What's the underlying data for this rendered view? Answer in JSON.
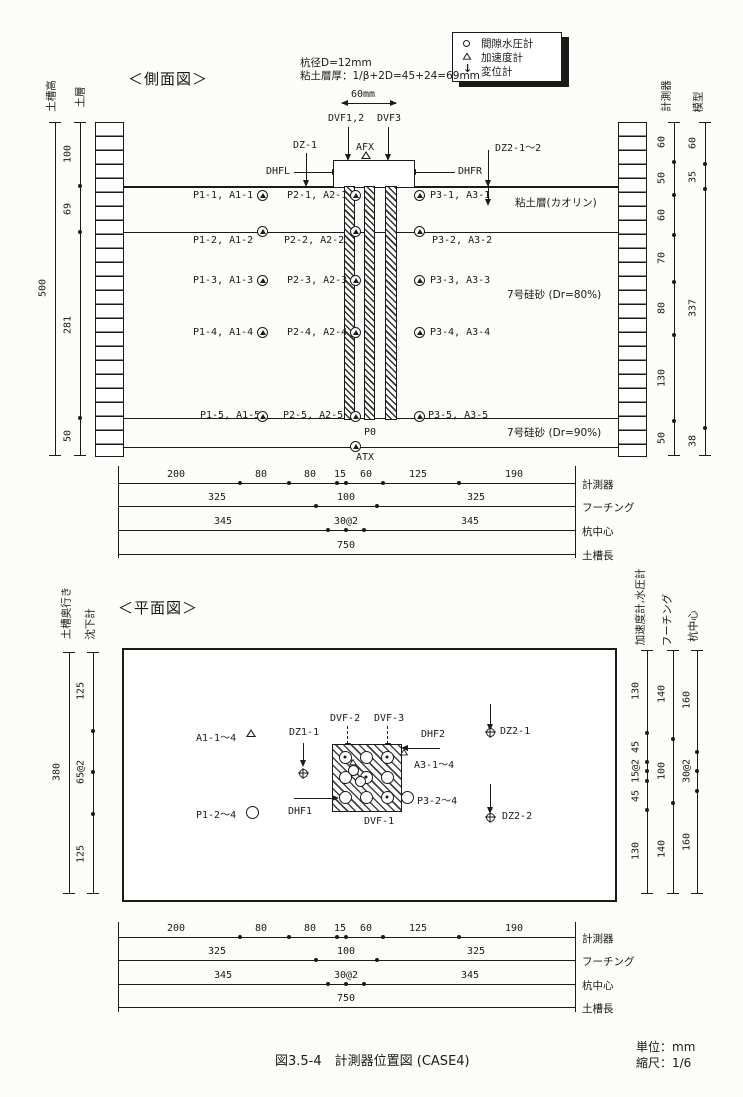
{
  "legend": {
    "items": [
      {
        "icon": "circle",
        "label": "間隙水圧計"
      },
      {
        "icon": "triangle",
        "label": "加速度計"
      },
      {
        "icon": "arrow-down",
        "label": "変位計"
      }
    ]
  },
  "side_view": {
    "title": "＜側面図＞",
    "notes": {
      "line1": "杭径D=12mm",
      "line2": "粘土層厚：1/β+2D=45+24=69mm"
    },
    "width_label": "60mm",
    "labels": {
      "dvf12": "DVF1,2",
      "dvf3": "DVF3",
      "dz1": "DZ-1",
      "afx": "AFX",
      "dhfl": "DHFL",
      "dhfr": "DHFR",
      "dz2": "DZ2-1〜2",
      "p0": "P0",
      "atx": "ATX"
    },
    "soil": {
      "clay": "粘土層(カオリン)",
      "sand80": "7号硅砂 (Dr=80%)",
      "sand90": "7号硅砂 (Dr=90%)"
    },
    "rows": [
      {
        "left": "P1-1, A1-1",
        "center": "P2-1, A2-1",
        "right": "P3-1, A3-1"
      },
      {
        "left": "P1-2, A1-2",
        "center": "P2-2, A2-2",
        "right": "P3-2, A3-2"
      },
      {
        "left": "P1-3, A1-3",
        "center": "P2-3, A2-3",
        "right": "P3-3, A3-3"
      },
      {
        "left": "P1-4, A1-4",
        "center": "P2-4, A2-4",
        "right": "P3-4, A3-4"
      },
      {
        "left": "P1-5, A1-5",
        "center": "P2-5, A2-5",
        "right": "P3-5, A3-5"
      }
    ],
    "left_dims": {
      "header_outer": "土槽高",
      "header_inner": "土層",
      "total": "500",
      "segments": [
        "100",
        "69",
        "281",
        "50"
      ]
    },
    "right_dims": {
      "header_col1": "計測器",
      "header_col2": "模型",
      "col1_segments": [
        "60",
        "50",
        "60",
        "70",
        "80",
        "130",
        "50"
      ],
      "col2_segments": [
        "60",
        "35",
        "337",
        "38"
      ]
    }
  },
  "plan_view": {
    "title": "＜平面図＞",
    "labels": {
      "a1": "A1-1〜4",
      "dz11": "DZ1-1",
      "dvf2": "DVF-2",
      "dvf3": "DVF-3",
      "dhf2": "DHF2",
      "a3": "A3-1〜4",
      "p3": "P3-2〜4",
      "dhf1": "DHF1",
      "dvf1": "DVF-1",
      "p1": "P1-2〜4",
      "dz21": "DZ2-1",
      "dz22": "DZ2-2"
    },
    "left_dims": {
      "header_outer": "土槽奥行き",
      "header_inner": "沈下計",
      "total": "380",
      "segments": [
        "125",
        "65@2",
        "125"
      ]
    },
    "right_dims": {
      "header_col1": "加速度計,水圧計",
      "header_col2": "フーチング",
      "header_col3": "杭中心",
      "col1_segments": [
        "130",
        "45",
        "15@2",
        "45",
        "130"
      ],
      "col2_segments": [
        "140",
        "100",
        "140"
      ],
      "col3_segments": [
        "160",
        "30@2",
        "160"
      ]
    }
  },
  "dim_table": {
    "rows": [
      {
        "label": "計測器",
        "values": [
          "200",
          "80",
          "80",
          "15",
          "60",
          "125",
          "190"
        ]
      },
      {
        "label": "フーチング",
        "values": [
          "325",
          "100",
          "325"
        ]
      },
      {
        "label": "杭中心",
        "values": [
          "345",
          "30@2",
          "345"
        ]
      },
      {
        "label": "土槽長",
        "values": [
          "750"
        ]
      }
    ]
  },
  "footer": {
    "caption": "図3.5-4　計測器位置図 (CASE4)",
    "unit": "単位：mm",
    "scale": "縮尺：1/6"
  }
}
